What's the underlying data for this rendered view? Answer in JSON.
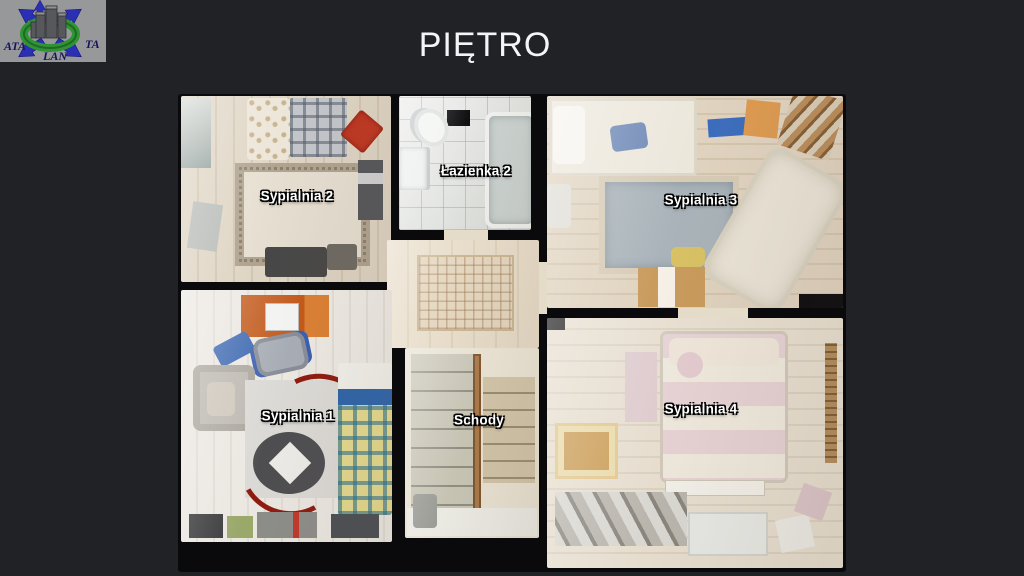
{
  "page": {
    "title": "PIĘTRO",
    "background_color": "#202226"
  },
  "logo": {
    "text_left": "ATA",
    "text_right": "TA",
    "text_bottom": "LAN",
    "background_color": "#97989a",
    "arrow_color": "#2b2fb4",
    "ring_color": "#2f9434",
    "text_color": "#15155c"
  },
  "floor_plan": {
    "wall_color": "#0a0a0c",
    "rooms": [
      {
        "id": "sypialnia-2",
        "label": "Sypialnia 2"
      },
      {
        "id": "lazienka-2",
        "label": "Łazienka 2"
      },
      {
        "id": "sypialnia-3",
        "label": "Sypialnia 3"
      },
      {
        "id": "sypialnia-1",
        "label": "Sypialnia 1"
      },
      {
        "id": "schody",
        "label": "Schody"
      },
      {
        "id": "sypialnia-4",
        "label": "Sypialnia 4"
      }
    ],
    "accent_colors": {
      "red_pillow": "#bf3722",
      "orange_desk": "#c2591b",
      "blue_bedding": "#2f64a8",
      "plaid_blanket": "#c3c6cb"
    }
  }
}
